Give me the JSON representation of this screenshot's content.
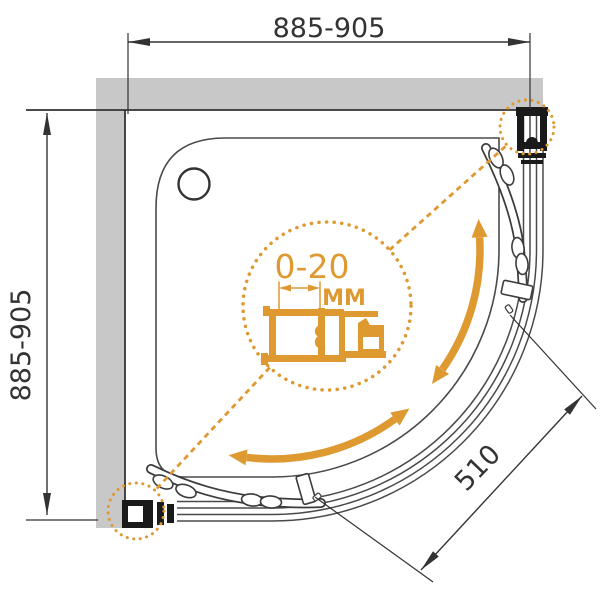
{
  "title": "Quadrant shower enclosure installation diagram",
  "dimensions": {
    "width_top": {
      "label": "885-905"
    },
    "height_left": {
      "label": "885-905"
    },
    "diagonal_opening": {
      "label": "510"
    }
  },
  "detail": {
    "adjustment_range": "0-20",
    "unit": "MM"
  },
  "icons": [
    "detail-magnifier-circle",
    "callout-dotted-circle",
    "double-curved-arrow",
    "dimension-arrow"
  ],
  "colors": {
    "accent": "#DE9931",
    "line": "#4a4a4a",
    "dim": "#333333",
    "wall": "#c8c8c8",
    "pblack": "#1a1a1a"
  }
}
